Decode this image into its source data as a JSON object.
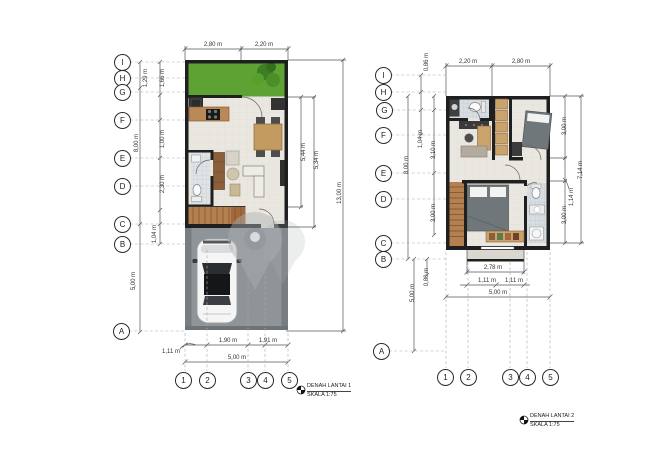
{
  "plan1": {
    "title": "DENAH LANTAI 1",
    "scale": "SKALA 1:75",
    "grid_letters": [
      "I",
      "H",
      "G",
      "F",
      "E",
      "D",
      "C",
      "B",
      "A"
    ],
    "grid_numbers": [
      "1",
      "2",
      "3",
      "4",
      "5"
    ],
    "dim_top": [
      "2,80 m",
      "2,20 m"
    ],
    "dim_left": [
      "1,29 m",
      "1,66 m",
      "1,00 m",
      "8,00 m",
      "2,30 m",
      "1,04 m",
      "5,00 m"
    ],
    "dim_right": [
      "5,44 m",
      "5,34 m",
      "13,00 m"
    ],
    "dim_bottom": [
      "1,11 m",
      "1,90 m",
      "1,91 m",
      "5,00 m"
    ]
  },
  "plan2": {
    "title": "DENAH LANTAI 2",
    "scale": "SKALA 1:75",
    "grid_letters": [
      "I",
      "H",
      "G",
      "F",
      "E",
      "D",
      "C",
      "B",
      "A"
    ],
    "grid_numbers": [
      "1",
      "2",
      "3",
      "4",
      "5"
    ],
    "dim_top": [
      "2,20 m",
      "2,80 m"
    ],
    "dim_left": [
      "0,86 m",
      "1,04 m",
      "8,00 m",
      "3,10 m",
      "3,00 m",
      "0,80 m",
      "5,00 m"
    ],
    "dim_right": [
      "3,00 m",
      "1,14 m",
      "7,14 m",
      "3,00 m"
    ],
    "dim_bottom": [
      "2,78 m",
      "1,11 m",
      "1,11 m",
      "5,00 m"
    ]
  },
  "colors": {
    "wall": "#1f1f1f",
    "floor": "#eae7e0",
    "garden": "#5ea233",
    "carport": "#8f9499",
    "stairs_wood": "#b5804f",
    "bath_tile": "#d7dde1"
  }
}
